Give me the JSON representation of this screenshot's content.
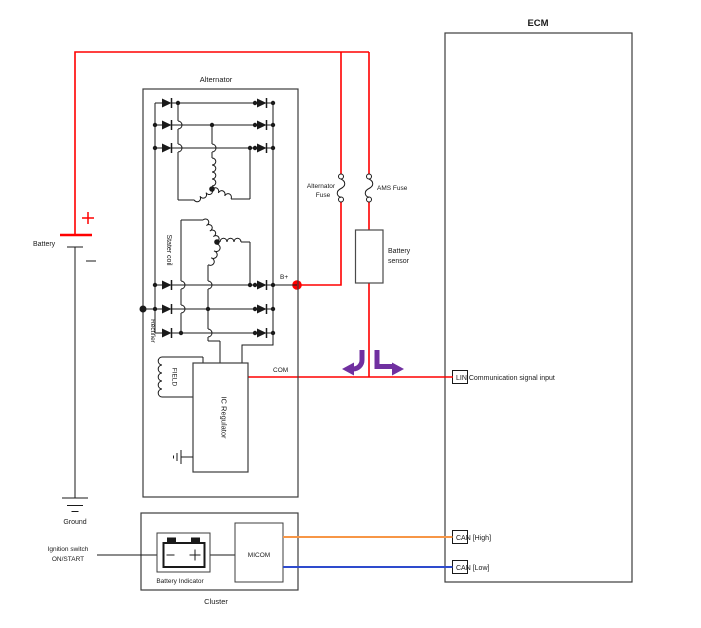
{
  "colors": {
    "power_wire": "#ff0000",
    "can_high_wire": "#f79646",
    "can_low_wire": "#2e4bcd",
    "lin_arrow": "#7030a0"
  },
  "power": {
    "battery": "Battery",
    "ground": "Ground",
    "alternator_fuse_line1": "Alternator",
    "alternator_fuse_line2": "Fuse",
    "ams_fuse": "AMS Fuse",
    "battery_sensor_line1": "Battery",
    "battery_sensor_line2": "sensor",
    "b_plus": "B+"
  },
  "alternator": {
    "title": "Alternator",
    "stator_coil": "Stater coil",
    "rectifier": "Rectifier",
    "field": "FIELD",
    "ic_regulator": "IC Regulator",
    "com": "COM"
  },
  "ecm": {
    "title": "ECM",
    "lin_input": "LIN Communication signal input",
    "can_high": "CAN [High]",
    "can_low": "CAN [Low]"
  },
  "cluster": {
    "title": "Cluster",
    "ignition_line1": "Ignition switch",
    "ignition_line2": "ON/START",
    "battery_indicator": "Battery Indicator",
    "micom": "MICOM"
  }
}
